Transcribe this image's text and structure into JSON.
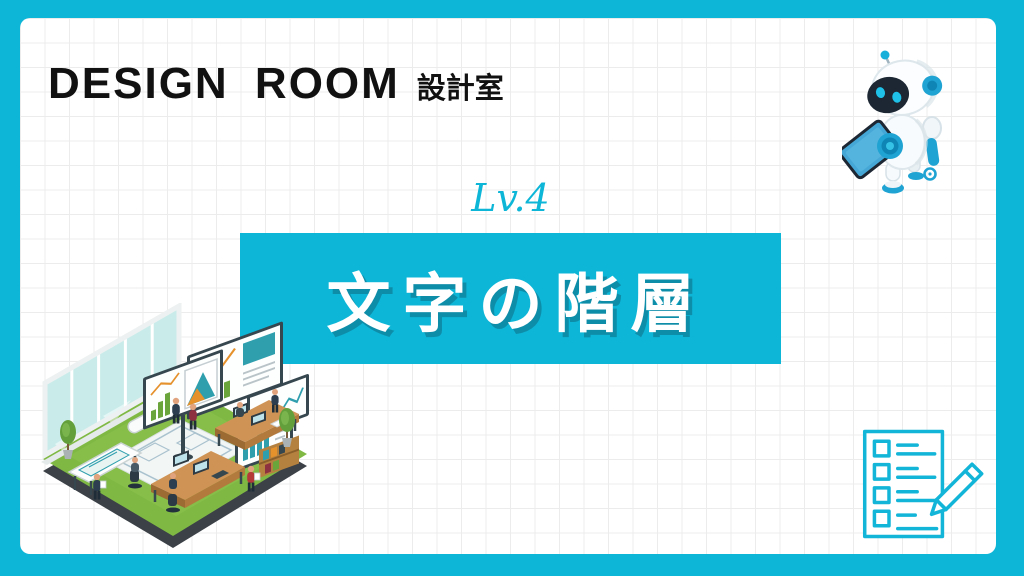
{
  "theme": {
    "accent": "#0db6d7",
    "accent_dark": "#0f85b5",
    "paper": "#ffffff",
    "grid_line": "#ececec",
    "ink": "#111111",
    "banner_text": "#ffffff"
  },
  "header": {
    "brand_title": "DESIGN ROOM",
    "brand_subtitle": "設計室"
  },
  "hero": {
    "level_label": "Lv.4",
    "title": "文字の階層"
  },
  "illustrations": {
    "robot": "robot-with-tablet-icon",
    "office": "isometric-design-office-illustration",
    "checklist": "checklist-with-pencil-icon"
  }
}
